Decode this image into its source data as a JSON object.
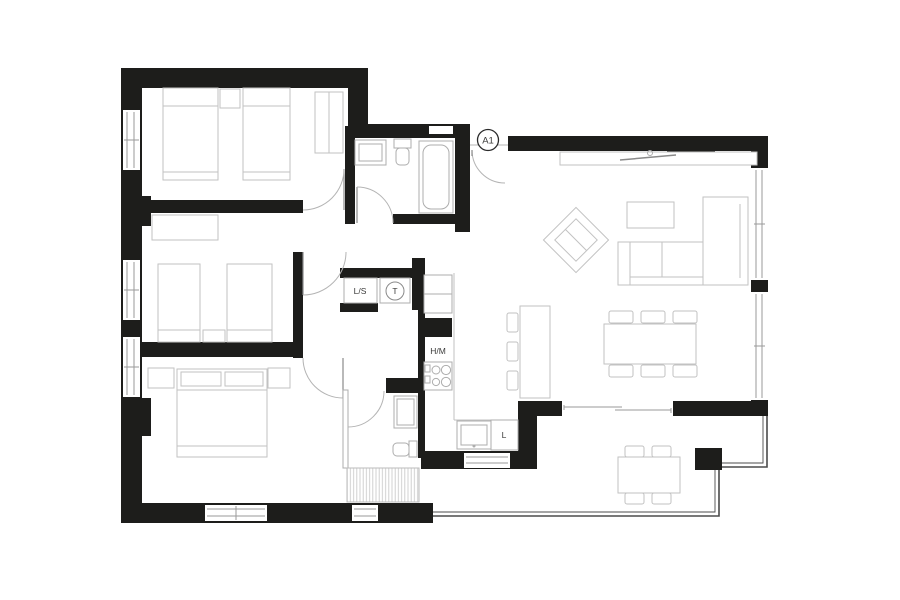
{
  "plan": {
    "type": "apartment-floor-plan",
    "entrance": {
      "label": "A1"
    },
    "laundry": {
      "washer": "L/S",
      "dryer": "T"
    },
    "kitchen": {
      "appliance_hm": "H/M",
      "dishwasher": "L"
    }
  },
  "colors": {
    "background": "#ffffff",
    "wall": "#1d1d1b",
    "furniture": "#c2c2c2",
    "fixture": "#9a9a9a",
    "label": "#3a3a39",
    "railing": "#4b4b4b"
  }
}
